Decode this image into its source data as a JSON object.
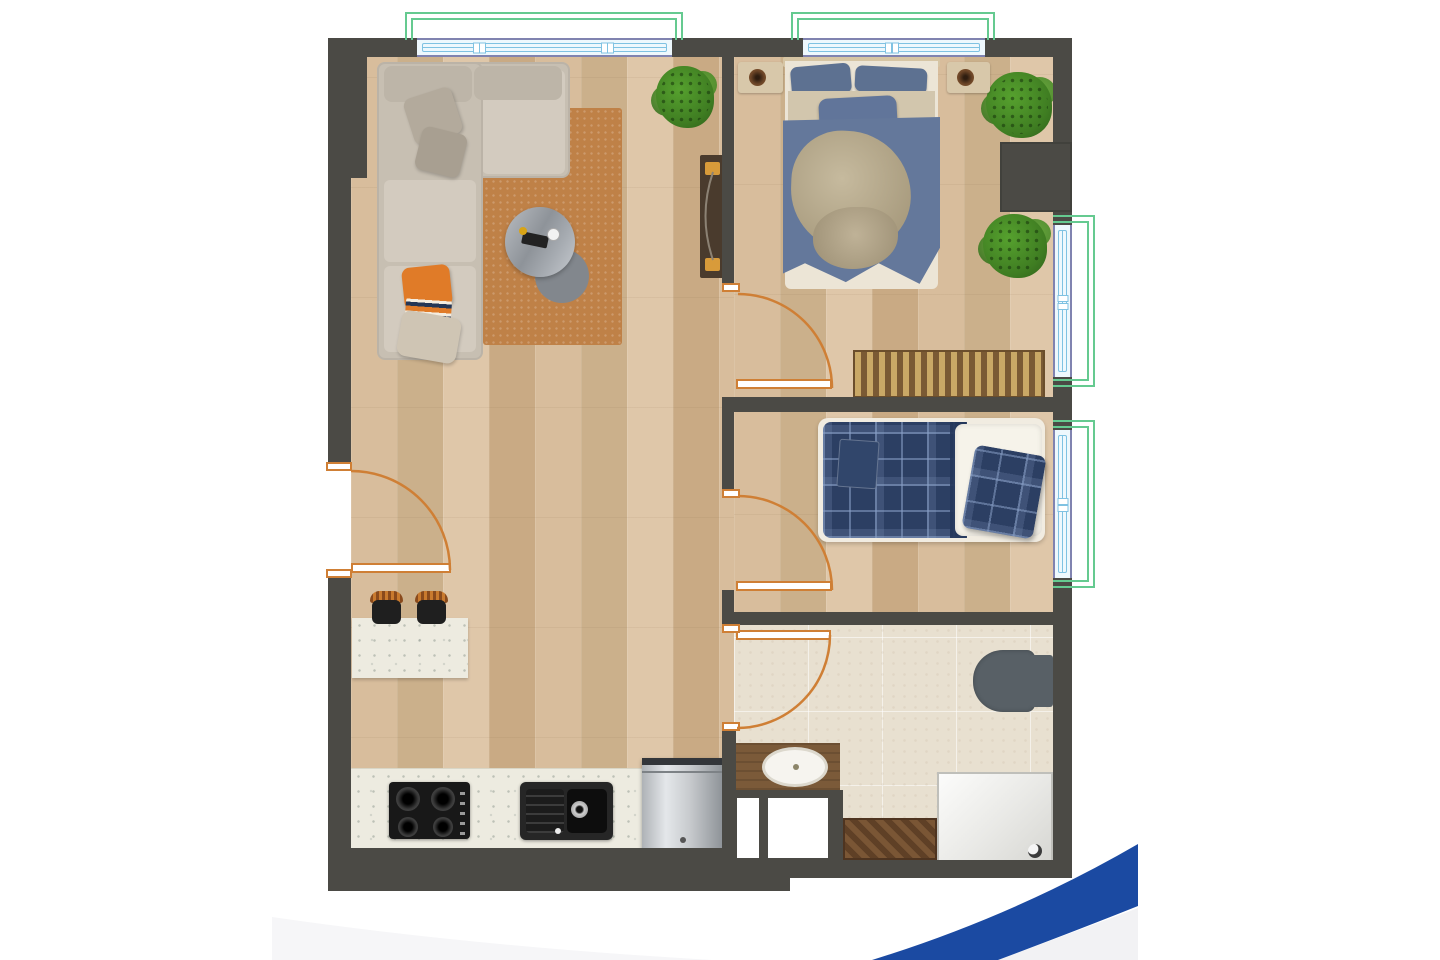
{
  "scene": {
    "type": "apartment-floor-plan-top-view",
    "rooms": [
      "living-room",
      "kitchen",
      "hallway",
      "bedroom-main",
      "bedroom-single",
      "bathroom"
    ],
    "window_count": 4,
    "door_count": 4
  },
  "inventory": {
    "living_room": [
      "l-shaped-sofa",
      "throw-pillows",
      "area-rug",
      "round-coffee-table",
      "tv-console",
      "plant"
    ],
    "bedroom_main": [
      "double-bed",
      "headboard",
      "nightstand-left",
      "nightstand-right",
      "lamps",
      "slatted-dresser",
      "plant-top",
      "plant-middle",
      "wardrobe-recess"
    ],
    "bedroom_single": [
      "single-bed-plaid",
      "white-pillow",
      "plaid-pillow",
      "folded-blanket"
    ],
    "bathroom": [
      "toilet",
      "vanity-with-sink",
      "shower-tray",
      "wood-mat",
      "storage-niches"
    ],
    "kitchen": [
      "island-counter",
      "bar-stools",
      "cooktop-4-burner",
      "double-sink",
      "fridge",
      "worktop"
    ]
  },
  "colors": {
    "page-bg": "#ffffff",
    "wall": "#4b4a45",
    "wood-a": "#d5b996",
    "wood-b": "#d8bd9c",
    "wood-c": "#cbb08b",
    "wood-d": "#dfc7a9",
    "wood-b2": "#c9aa84",
    "tile": "#e8e0d0",
    "counter": "#edebe0",
    "wf": "#65ca90",
    "wb": "#8083b0",
    "wl": "#7fc2e2",
    "wg": "#eef8fd",
    "door": "#cf7f35",
    "rug": "#bf8147",
    "sofa": "#c7bfb2",
    "sofa-lt": "#d3cbbf",
    "accent": "#e07b28",
    "duvet": "#64789b",
    "pillow-blue": "#5d7191",
    "blanket": "#b5a88c",
    "plaid": "#2c3f63",
    "plaid-line": "rgba(137,160,199,0.55)",
    "plant-a": "#3f7d22",
    "plant-b": "#56a12e",
    "plant-c": "#2e5f1a",
    "dark-app": "#181818",
    "vanity": "#7b5a39",
    "toilet": "#586066",
    "mat": "#6b4a2e",
    "blue": "#1b4aa2",
    "pale": "#f2f2f4"
  }
}
